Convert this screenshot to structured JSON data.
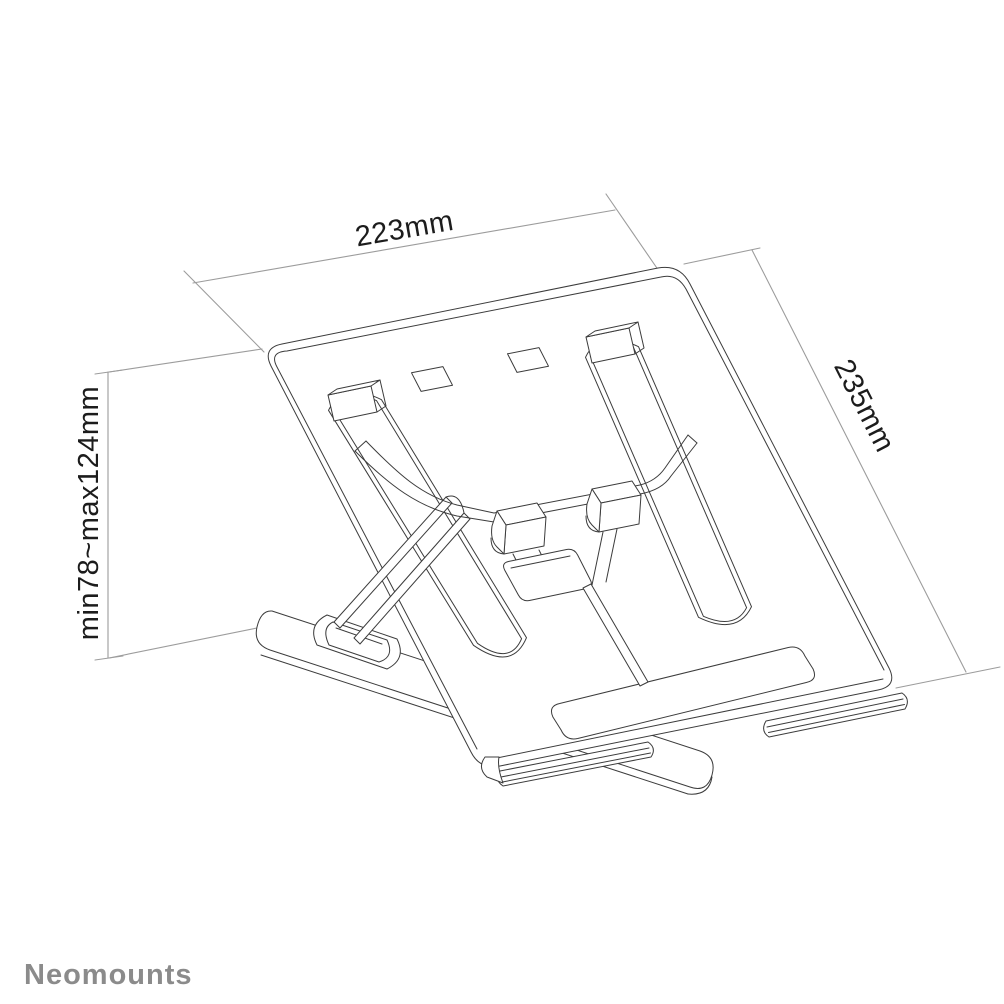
{
  "drawing": {
    "subject": "laptop stand technical drawing",
    "dimensions": {
      "width": "223mm",
      "depth": "235mm",
      "height": "min78~max124mm"
    },
    "colors": {
      "outline": "#3c3c3c",
      "dimension_line": "#9c9c9c",
      "label_text": "#1c1c1c",
      "brand_text": "#8b8b8b",
      "background": "#ffffff"
    }
  },
  "footer": {
    "brand": "Neomounts"
  }
}
